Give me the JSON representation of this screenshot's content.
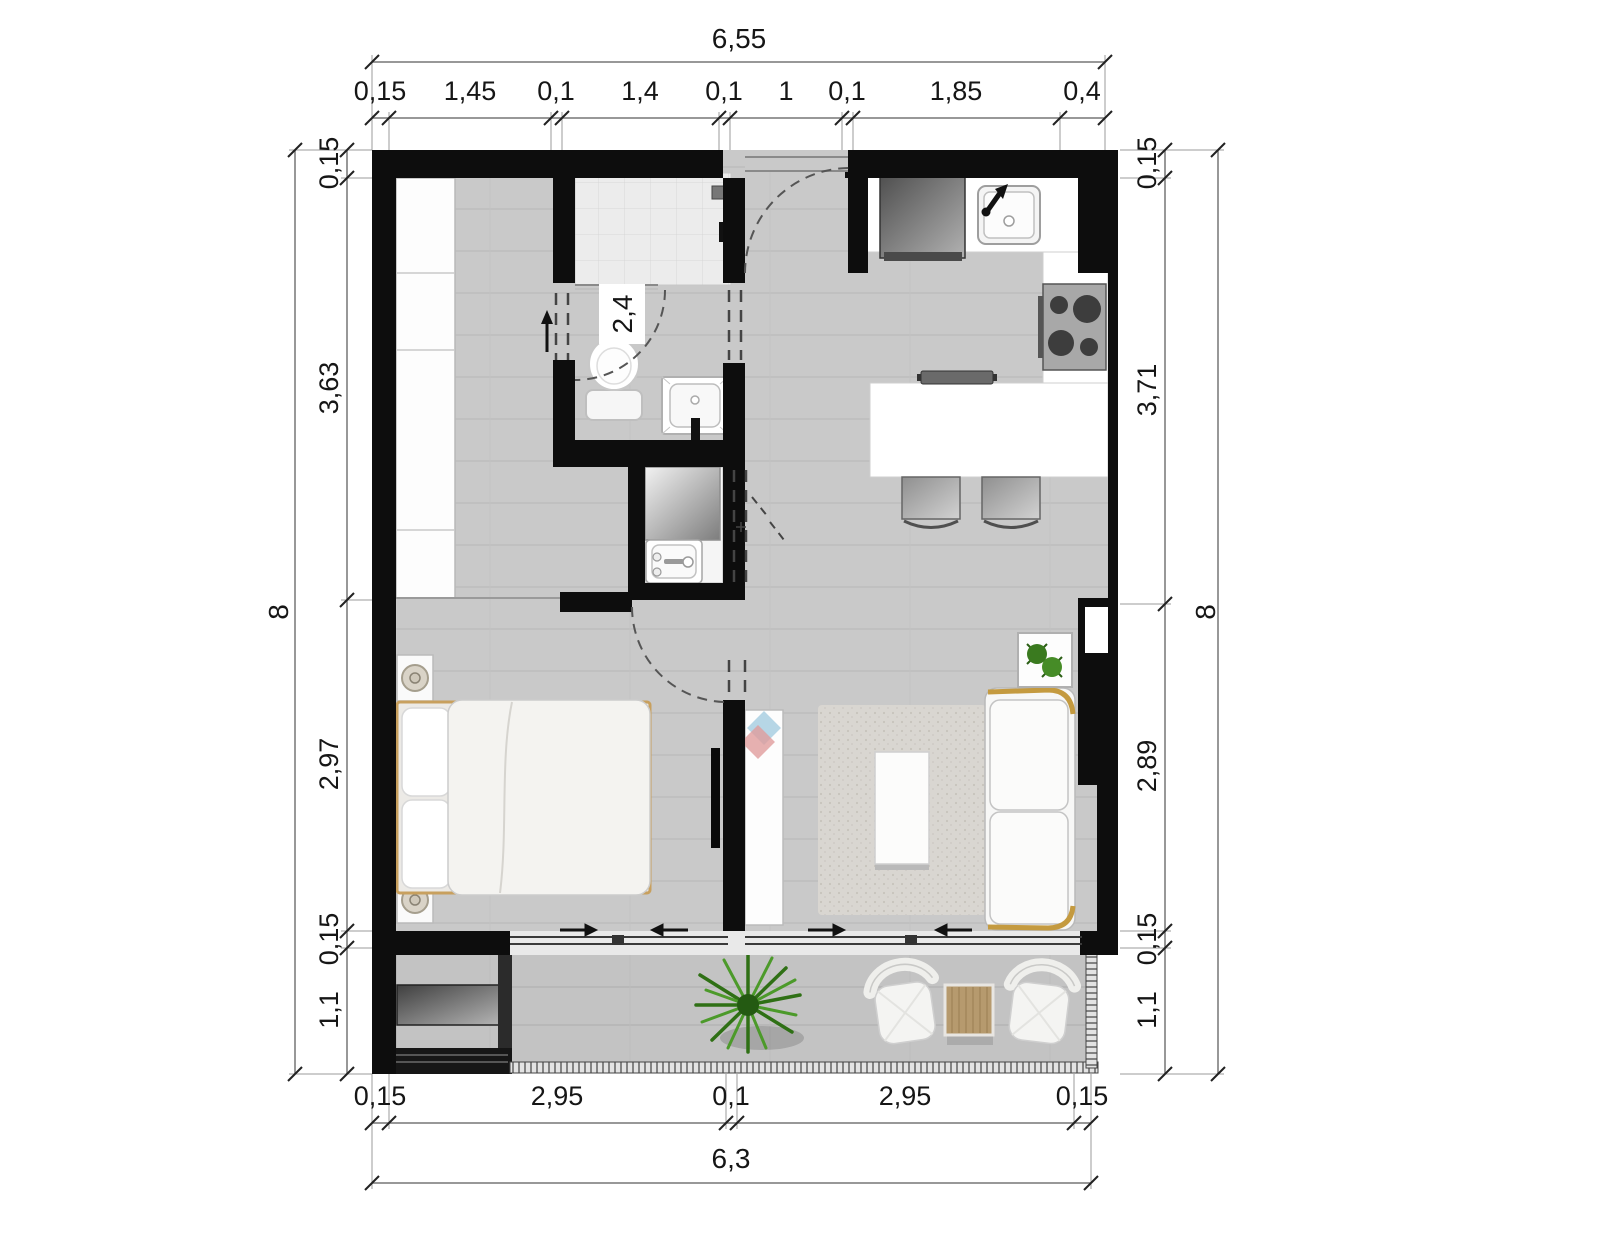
{
  "plan": {
    "dimensions": {
      "top": {
        "overall": "6,55",
        "segments": [
          "0,15",
          "1,45",
          "0,1",
          "1,4",
          "0,1",
          "1",
          "0,1",
          "1,85",
          "0,4"
        ]
      },
      "bottom": {
        "overall": "6,3",
        "segments": [
          "0,15",
          "2,95",
          "0,1",
          "2,95",
          "0,15"
        ]
      },
      "left": {
        "overall": "8",
        "segments": [
          "0,15",
          "3,63",
          "2,97",
          "0,15",
          "1,1"
        ]
      },
      "right": {
        "overall": "8",
        "segments": [
          "0,15",
          "3,71",
          "2,89",
          "0,15",
          "1,1"
        ]
      }
    },
    "annotations": {
      "ceiling_height": "2,4"
    },
    "fixtures": [
      "exterior-wall",
      "interior-wall",
      "entry-door",
      "hall-wardrobe",
      "shower",
      "shower-head",
      "toilet",
      "washbasin",
      "utility-closet",
      "mirror-panel",
      "laundry-sink",
      "refrigerator",
      "kitchen-sink",
      "cooktop",
      "kitchen-counter",
      "island-counter",
      "bar-stool",
      "cutting-board",
      "double-bed",
      "pillow",
      "nightstand",
      "table-lamp",
      "tv",
      "tv-cabinet",
      "brand-logo",
      "rug",
      "coffee-table",
      "sofa",
      "plant-stand",
      "sliding-door",
      "balcony",
      "balcony-railing",
      "outdoor-plant",
      "lounge-chair",
      "outdoor-side-table",
      "ac-unit"
    ],
    "colors": {
      "wall": "#0d0d0d",
      "floor": "#c9c9c9",
      "balcony_floor": "#c3c3c3",
      "tile": "#ececec",
      "rug": "#d9d6d1",
      "counter": "#ffffff",
      "wood_accent": "#c8a05e",
      "sofa_trim": "#c49a3f",
      "plant_green": "#2f7015",
      "logo_blue": "#a9cfe2",
      "logo_pink": "#e09c9c",
      "dimension_line": "#777777",
      "text": "#161616"
    }
  }
}
